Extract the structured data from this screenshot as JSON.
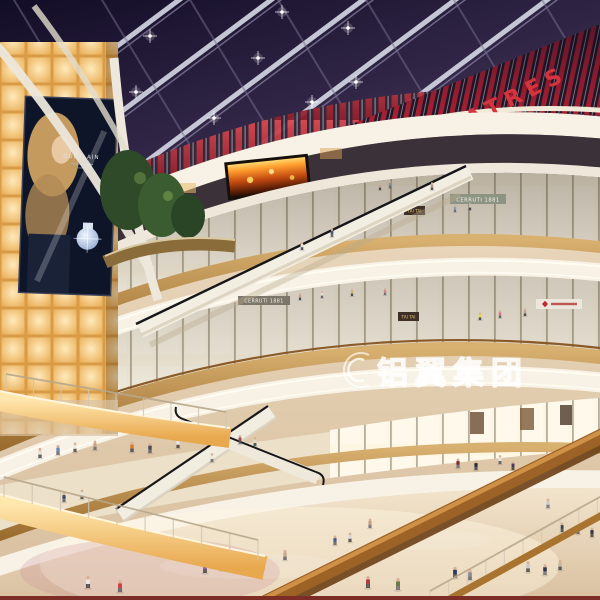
{
  "scene_title": "Mall Atrium Night Rendering",
  "signs": {
    "theatres": "THEATRES",
    "tai_tai_upper": "TAI TAI",
    "tai_tai_lower": "TAI TAI",
    "cerruti_upper": "CERRUTI 1881",
    "cerruti_center": "CERRUTI 1881",
    "billboard_brand": "GUERLAIN"
  },
  "watermark": {
    "text": "铝翼集团",
    "logo": "swirl-ribbon-icon"
  },
  "icons": {
    "watermark_logo": "swirl-ribbon-icon",
    "store_logo": "red-diamond-icon",
    "ceiling_lights": "starburst-light-icon"
  },
  "colors": {
    "sky": "#2a2142",
    "accent_red": "#c42430",
    "theatre_letter_red": "#d5343f",
    "wood": "#b9884a",
    "cream_fascia": "#f8f2e6",
    "amber_glow": "#f5c878",
    "floor": "#e8d5b8",
    "led_fire": "#e8761c"
  }
}
